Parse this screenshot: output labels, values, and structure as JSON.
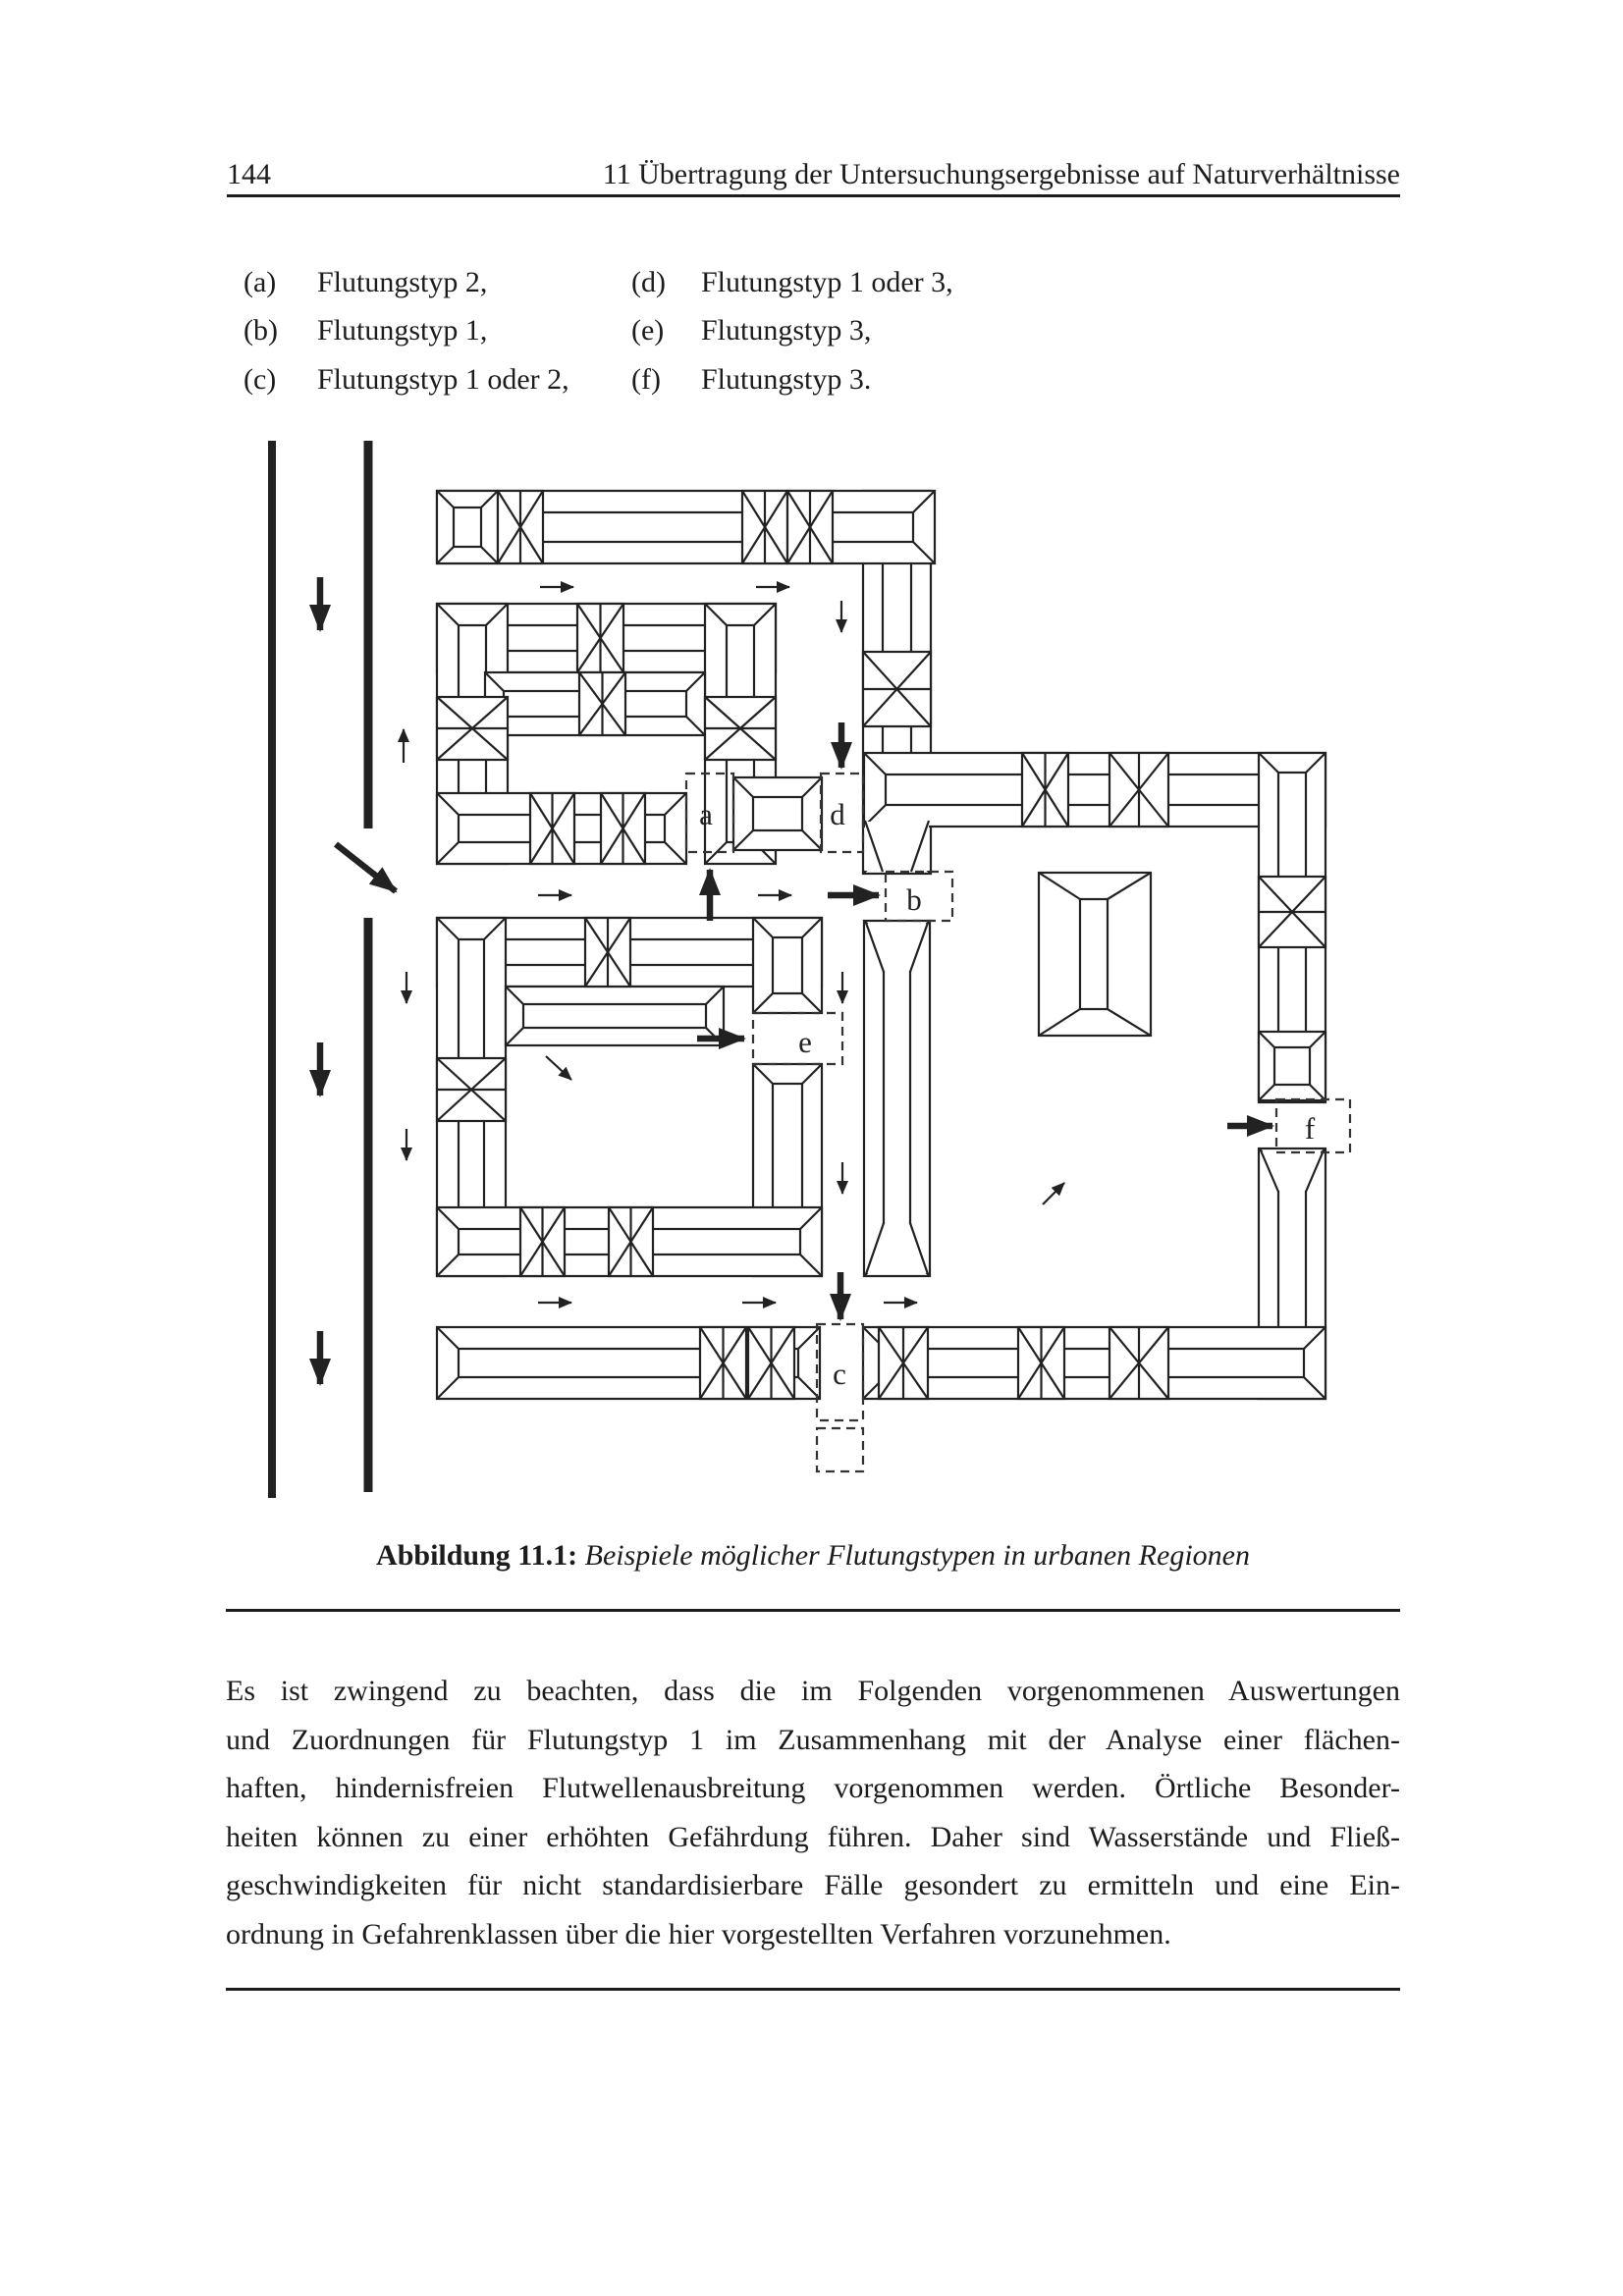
{
  "page": {
    "number": "144",
    "chapter_header": "11 Übertragung der Untersuchungsergebnisse auf Naturverhältnisse"
  },
  "flutungstyp_list": {
    "items": [
      {
        "label": "(a)",
        "text": "Flutungstyp 2,"
      },
      {
        "label": "(b)",
        "text": "Flutungstyp 1,"
      },
      {
        "label": "(c)",
        "text": "Flutungstyp 1 oder 2,"
      },
      {
        "label": "(d)",
        "text": "Flutungstyp 1 oder 3,"
      },
      {
        "label": "(e)",
        "text": "Flutungstyp 3,"
      },
      {
        "label": "(f)",
        "text": "Flutungstyp 3."
      }
    ]
  },
  "figure": {
    "caption_label": "Abbildung 11.1:",
    "caption_text": "Beispiele möglicher Flutungstypen in urbanen Regionen",
    "markers": [
      {
        "letter": "a",
        "box": [
          699,
          788,
          48,
          80
        ],
        "label_pos": [
          719,
          840
        ]
      },
      {
        "letter": "b",
        "box": [
          902,
          888,
          68,
          50
        ],
        "label_pos": [
          931,
          927
        ]
      },
      {
        "letter": "c",
        "box": [
          832,
          1349,
          47,
          98
        ],
        "label_pos": [
          855,
          1410
        ]
      },
      {
        "letter": "d",
        "box": [
          836,
          788,
          43,
          80
        ],
        "label_pos": [
          853,
          840
        ]
      },
      {
        "letter": "e",
        "box": [
          767,
          1032,
          91,
          52
        ],
        "label_pos": [
          820,
          1072
        ]
      },
      {
        "letter": "f",
        "box": [
          1300,
          1120,
          75,
          54
        ],
        "label_pos": [
          1334,
          1160
        ]
      }
    ],
    "extra_dashed_boxes": [
      [
        832,
        1455,
        47,
        44
      ]
    ],
    "river_lines": [
      [
        277,
        449,
        1526,
        8
      ],
      [
        375,
        449,
        844,
        9
      ],
      [
        375,
        935,
        1520,
        9
      ]
    ],
    "thick_arrows": [
      [
        326,
        588,
        326,
        642
      ],
      [
        326,
        1062,
        326,
        1116
      ],
      [
        326,
        1356,
        326,
        1410
      ],
      [
        342,
        860,
        403,
        908
      ],
      [
        857,
        736,
        857,
        782
      ],
      [
        723,
        938,
        723,
        886
      ],
      [
        843,
        912,
        895,
        912
      ],
      [
        710,
        1058,
        758,
        1058
      ],
      [
        1250,
        1147,
        1296,
        1147
      ],
      [
        856,
        1296,
        856,
        1344
      ]
    ],
    "thin_arrows": [
      [
        550,
        598,
        584,
        598
      ],
      [
        770,
        598,
        804,
        598
      ],
      [
        857,
        612,
        857,
        644
      ],
      [
        411,
        777,
        411,
        743
      ],
      [
        548,
        912,
        582,
        912
      ],
      [
        772,
        912,
        806,
        912
      ],
      [
        414,
        990,
        414,
        1022
      ],
      [
        414,
        1150,
        414,
        1182
      ],
      [
        858,
        990,
        858,
        1022
      ],
      [
        858,
        1184,
        858,
        1216
      ],
      [
        556,
        1076,
        582,
        1100
      ],
      [
        1062,
        1227,
        1084,
        1205
      ],
      [
        548,
        1327,
        582,
        1327
      ],
      [
        756,
        1327,
        790,
        1327
      ],
      [
        900,
        1327,
        934,
        1327
      ]
    ]
  },
  "paragraph": {
    "lines": [
      "Es ist zwingend zu beachten, dass die im Folgenden vorgenommenen Auswertungen",
      "und Zuordnungen für Flutungstyp 1 im Zusammenhang mit der Analyse einer flächen-",
      "haften, hindernisfreien Flutwellenausbreitung vorgenommen werden. Örtliche Besonder-",
      "heiten können zu einer erhöhten Gefährdung führen. Daher sind Wasserstände und Fließ-",
      "geschwindigkeiten für nicht standardisierbare Fälle gesondert zu ermitteln und eine Ein-",
      "ordnung in Gefahrenklassen über die hier vorgestellten Verfahren vorzunehmen."
    ]
  }
}
